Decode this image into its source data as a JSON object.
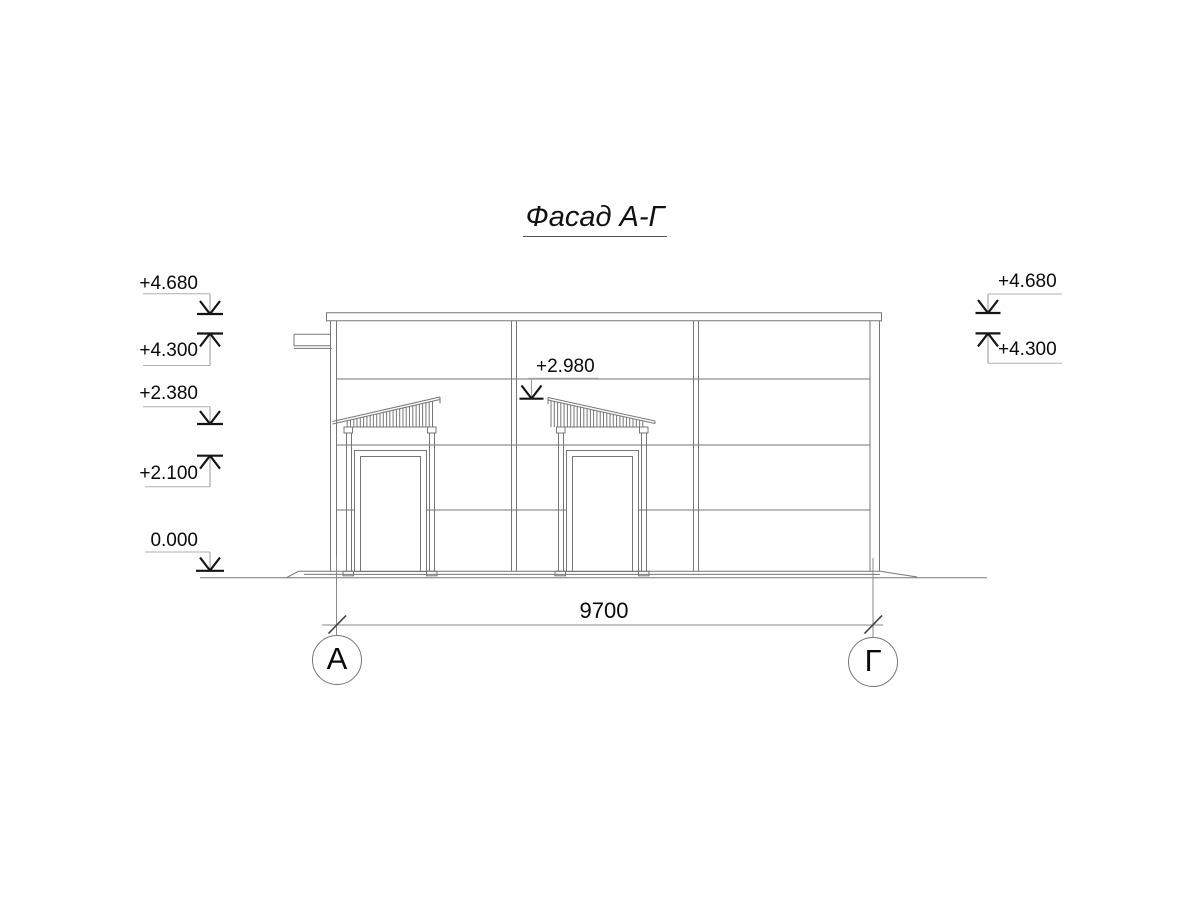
{
  "drawing": {
    "title": "Фасад А-Г",
    "elevation_marks": {
      "left": [
        {
          "value": "+4.680",
          "direction": "down"
        },
        {
          "value": "+4.300",
          "direction": "up"
        },
        {
          "value": "+2.380",
          "direction": "down"
        },
        {
          "value": "+2.100",
          "direction": "up"
        },
        {
          "value": "0.000",
          "direction": "down"
        }
      ],
      "middle": [
        {
          "value": "+2.980",
          "direction": "down"
        }
      ],
      "right": [
        {
          "value": "+4.680",
          "direction": "down"
        },
        {
          "value": "+4.300",
          "direction": "up"
        }
      ]
    },
    "dimensions": [
      {
        "value": "9700"
      }
    ],
    "axes": [
      {
        "label": "А"
      },
      {
        "label": "Г"
      }
    ],
    "colors": {
      "line": "#767676",
      "annotation": "#151515",
      "background": "#ffffff"
    }
  }
}
